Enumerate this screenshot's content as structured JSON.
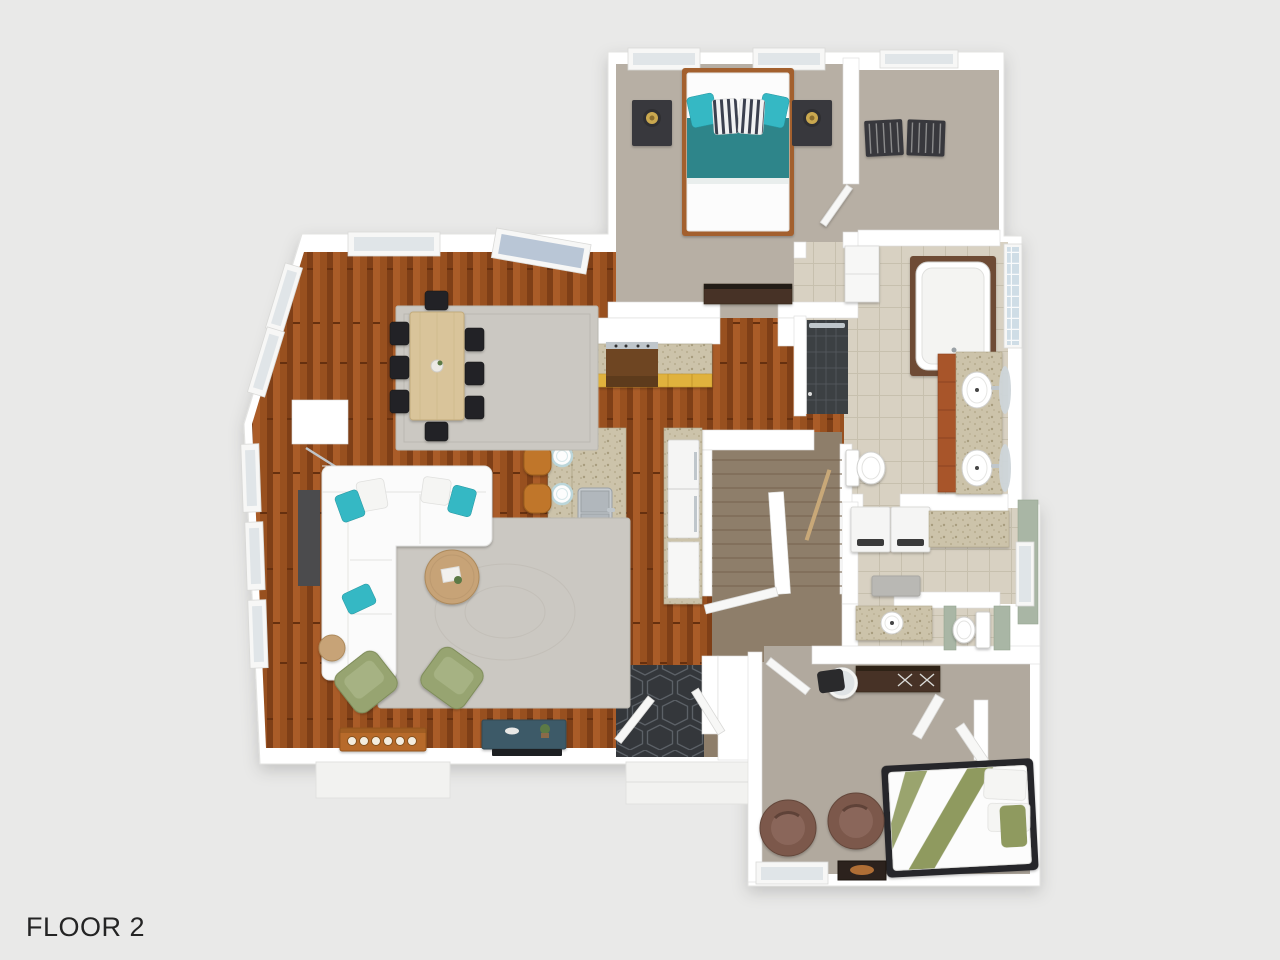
{
  "page": {
    "label": "FLOOR 2",
    "width": 1280,
    "height": 960
  },
  "palette": {
    "background": "#e9e9e8",
    "label_color": "#242424",
    "wall": "#ffffff",
    "wall_edge": "#dcdcda",
    "white_f": "#f7f7f6",
    "green_wall": "#a9b6a5",
    "carpet": "#b7afa4",
    "carpet2": "#b1a99e",
    "tile": "#d8d1c2",
    "tile_line": "#c7c0ae",
    "wood_a": "#98501f",
    "wood_b": "#7f3f17",
    "wood_c": "#aa5c28",
    "wood_seam": "#66300f",
    "stair_wood": "#8e7e6a",
    "stair_line": "#776650",
    "hex": "#34373b",
    "hex_line": "#5c6167",
    "glass": "#e0e5e8",
    "glass_blue": "#b9c6d6",
    "glass_block": "#cfdde6",
    "granite_a": "#ccc3aa",
    "granite_b": "#b9af92",
    "granite_dot": "#a79c7d",
    "granite_edge": "#b2a88c",
    "yellow": "#e0b23c",
    "yellow_edge": "#c3962c",
    "teal": "#35b8c4",
    "duvet": "#2f858a",
    "sofa": "#fbfbfb",
    "rug": "#cbc8c2",
    "tan": "#c7a377",
    "table_wood": "#d9c49a",
    "green_chair": "#97a471",
    "green_cushion": "#a6b283",
    "orange_side": "#b76b2c",
    "stool": "#c0762c",
    "console_teal": "#3e5a68",
    "vanity": "#a8542a",
    "olive": "#8f9a5e",
    "brown_chair": "#7b594b",
    "dark": "#39393c",
    "black": "#232326",
    "chrome": "#bfc6cb",
    "frame_wood": "#a3612f",
    "dresser": "#463325"
  },
  "plan": {
    "floor_name": "FLOOR 2",
    "view": "3d-top-down-render",
    "rooms": [
      {
        "name": "master-bedroom",
        "floor": "carpet",
        "furniture": [
          "double-bed-teal-bedding",
          "nightstand-left",
          "nightstand-right",
          "brass-table-lamps",
          "tv-dresser",
          "closet-door"
        ]
      },
      {
        "name": "walk-in-closet",
        "floor": "carpet",
        "furniture": [
          "luggage-rack",
          "luggage-rack"
        ]
      },
      {
        "name": "master-bathroom",
        "floor": "tile",
        "furniture": [
          "bathtub",
          "walk-in-shower",
          "double-vanity-two-sinks",
          "oval-mirrors",
          "toilet",
          "linen-cabinet",
          "glass-block-window"
        ]
      },
      {
        "name": "laundry-room",
        "floor": "tile",
        "furniture": [
          "washer",
          "dryer",
          "granite-counter",
          "floor-mat"
        ]
      },
      {
        "name": "bathroom-2",
        "floor": "tile",
        "furniture": [
          "vanity-sink",
          "toilet"
        ]
      },
      {
        "name": "stairwell",
        "floor": "wood",
        "furniture": [
          "staircase",
          "divider-wall",
          "handrail",
          "landing-railing"
        ]
      },
      {
        "name": "kitchen",
        "floor": "hardwood",
        "furniture": [
          "wall-counter-yellow-cabinets",
          "range",
          "island-with-sink",
          "place-settings",
          "bar-stools-x4",
          "refrigerator-column"
        ]
      },
      {
        "name": "dining-area",
        "floor": "hardwood",
        "furniture": [
          "dining-table",
          "dining-chairs-x8",
          "area-rug",
          "vase"
        ]
      },
      {
        "name": "living-room",
        "floor": "hardwood",
        "furniture": [
          "white-sectional-sofa",
          "teal-accent-pillows",
          "round-coffee-table",
          "round-side-table",
          "green-armchairs-x2",
          "dark-sofa-console",
          "orange-sideboard",
          "teal-media-console",
          "tv",
          "floor-lamp",
          "area-rug"
        ]
      },
      {
        "name": "entry",
        "floor": "hex-tile",
        "furniture": [
          "door-leaf",
          "door-leaf",
          "exterior-stoop"
        ]
      },
      {
        "name": "bedroom-2",
        "floor": "carpet",
        "furniture": [
          "bed-olive-stripe-bedding",
          "brown-swivel-chair",
          "brown-swivel-chair",
          "vanity-desk",
          "round-mirror",
          "stool",
          "bifold-closet-doors",
          "dark-rug",
          "door-leaf"
        ]
      }
    ]
  }
}
